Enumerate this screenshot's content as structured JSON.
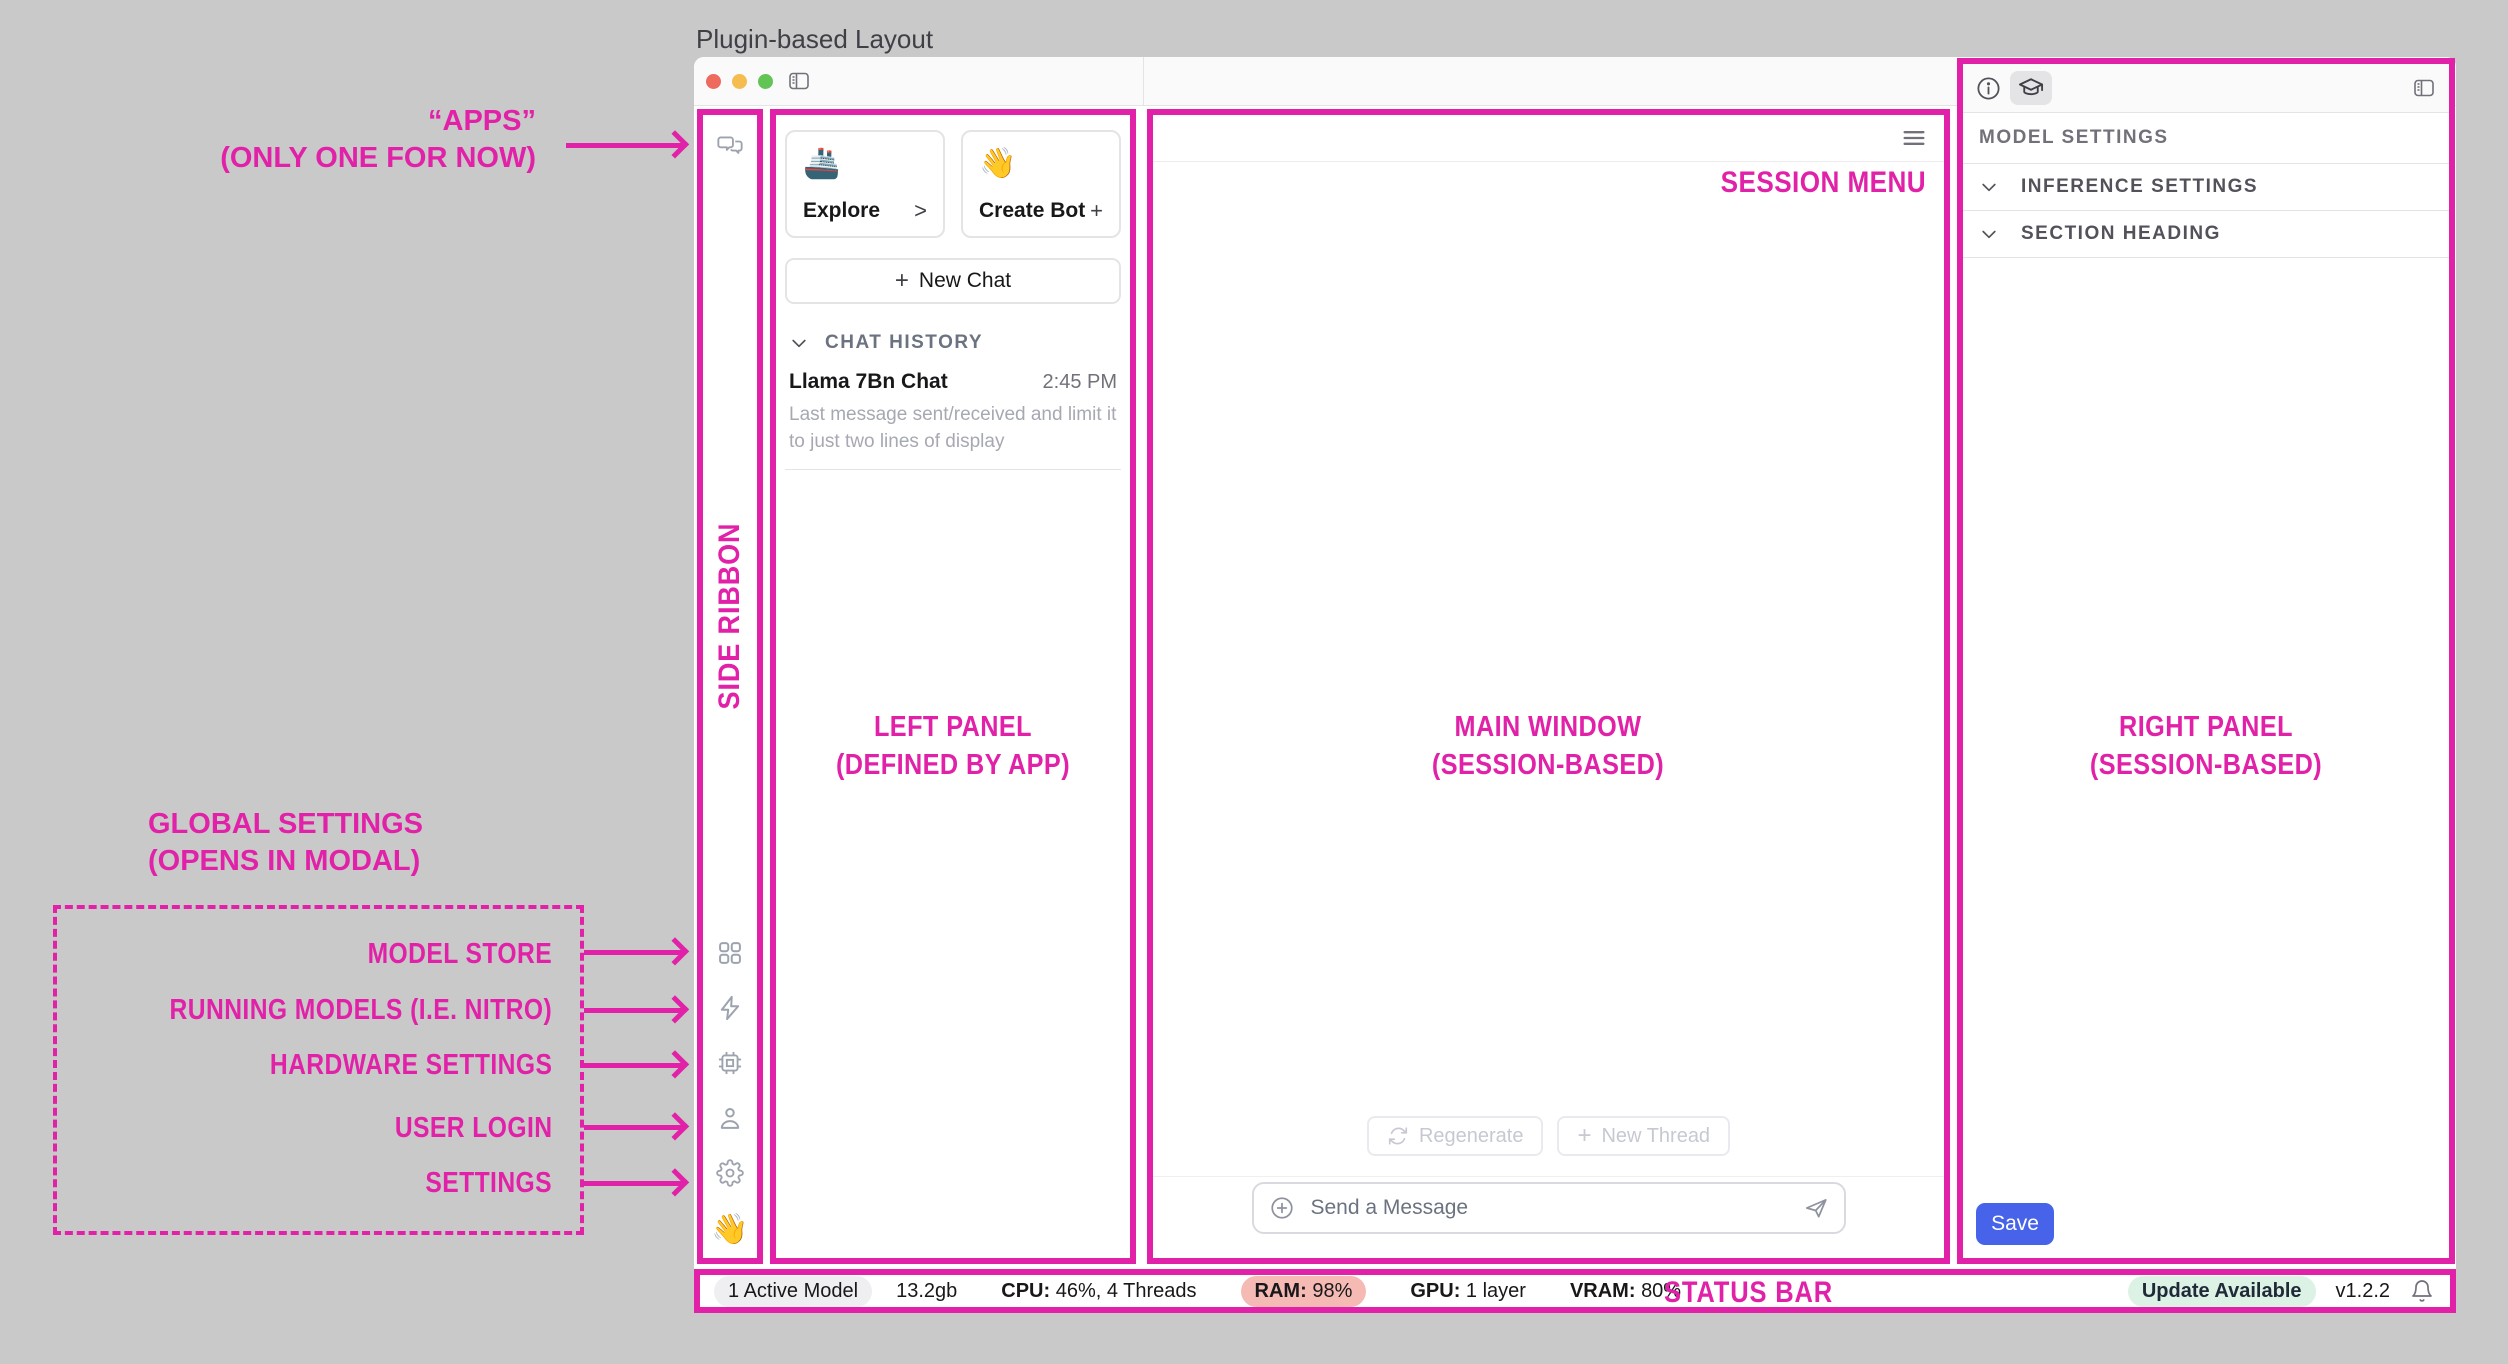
{
  "figure": {
    "title": "Plugin-based Layout"
  },
  "colors": {
    "annotation_magenta": "#E122A8",
    "save_button_blue": "#4663E9",
    "ram_badge_bg": "#F6BAB5",
    "update_badge_bg": "#DCF2E4",
    "traffic_red": "#EE6A5F",
    "traffic_yellow": "#F5BD4F",
    "traffic_green": "#61C454"
  },
  "annotations": {
    "apps_line1": "“APPS”",
    "apps_line2": "(ONLY ONE FOR NOW)",
    "side_ribbon": "SIDE RIBBON",
    "left_panel_line1": "LEFT PANEL",
    "left_panel_line2": "(DEFINED BY APP)",
    "main_window_line1": "MAIN WINDOW",
    "main_window_line2": "(SESSION-BASED)",
    "right_panel_line1": "RIGHT PANEL",
    "right_panel_line2": "(SESSION-BASED)",
    "session_menu": "SESSION MENU",
    "status_bar": "STATUS BAR",
    "global_line1": "GLOBAL SETTINGS",
    "global_line2": "(OPENS IN MODAL)",
    "modal_items": [
      "MODEL STORE",
      "RUNNING MODELS (I.E. NITRO)",
      "HARDWARE SETTINGS",
      "USER LOGIN",
      "SETTINGS"
    ]
  },
  "icons": {
    "ribbon_top": "chat-bubbles-icon",
    "ribbon_bottom": [
      "grid-icon",
      "lightning-icon",
      "chip-icon",
      "user-icon",
      "gear-icon",
      "wave-emoji"
    ],
    "titlebar": "sidebar-toggle-icon",
    "right_panel_tabs": [
      "info-icon",
      "graduation-cap-icon"
    ],
    "composer": [
      "plus-circle-icon",
      "send-icon"
    ],
    "status_right": "bell-icon"
  },
  "left_panel": {
    "explore_card": {
      "emoji": "🚢",
      "label": "Explore",
      "accessory": ">"
    },
    "create_bot_card": {
      "emoji": "👋",
      "label": "Create Bot",
      "accessory": "+"
    },
    "new_chat": {
      "plus": "+",
      "label": "New Chat"
    },
    "history_header": "CHAT HISTORY",
    "history_item": {
      "title": "Llama 7Bn Chat",
      "time": "2:45 PM",
      "preview": "Last message sent/received and limit it to just two lines of display"
    }
  },
  "ribbon": {
    "wave": "👋"
  },
  "main": {
    "regenerate": "Regenerate",
    "new_thread_plus": "+",
    "new_thread": "New Thread",
    "composer_placeholder": "Send a Message"
  },
  "right_panel": {
    "model_settings": "MODEL SETTINGS",
    "section_1": "INFERENCE SETTINGS",
    "section_2": "SECTION HEADING",
    "save": "Save"
  },
  "status_bar": {
    "active_model": "1 Active Model",
    "size": "13.2gb",
    "cpu_label": "CPU:",
    "cpu_value": "46%, 4 Threads",
    "ram_label": "RAM:",
    "ram_value": "98%",
    "gpu_label": "GPU:",
    "gpu_value": "1 layer",
    "vram_label": "VRAM:",
    "vram_value": "80%",
    "update": "Update Available",
    "version": "v1.2.2"
  }
}
